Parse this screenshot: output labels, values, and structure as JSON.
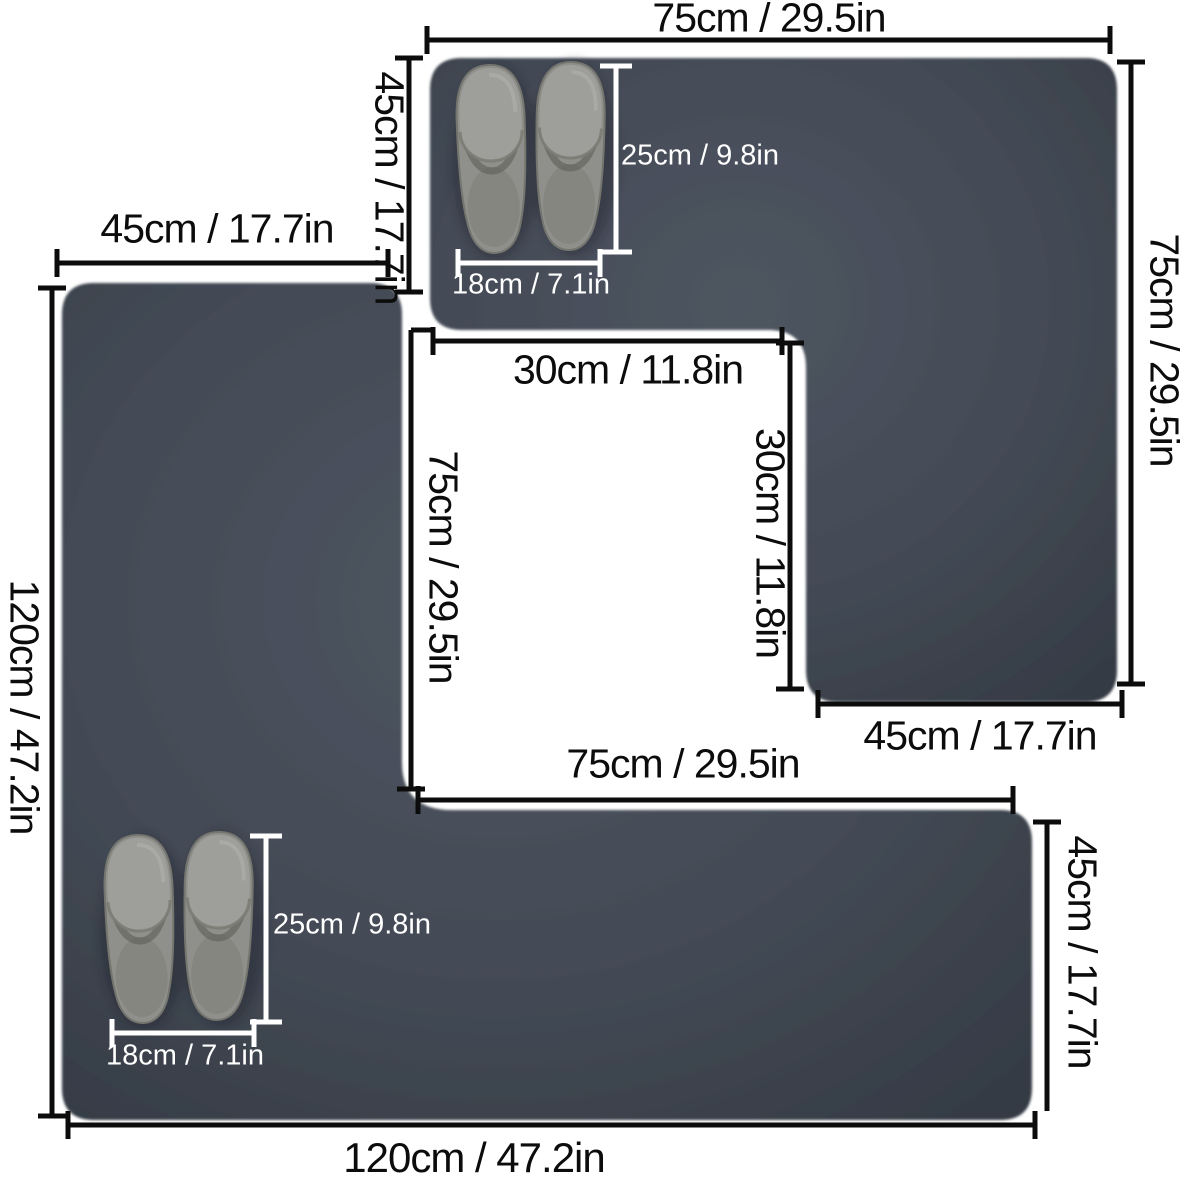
{
  "colors": {
    "background": "#ffffff",
    "mat": "#434a55",
    "mat_edge": "#343a44",
    "dimension_line": "#0c0c0c",
    "slipper_dimension_line": "#ffffff",
    "slipper": "#9a9a97"
  },
  "top_mat": {
    "top_width": "75cm / 29.5in",
    "left_height": "45cm / 17.7in",
    "right_height": "75cm / 29.5in",
    "notch_width": "30cm / 11.8in",
    "notch_height": "30cm / 11.8in",
    "foot_width": "45cm / 17.7in",
    "slipper_length": "25cm / 9.8in",
    "slipper_width": "18cm / 7.1in"
  },
  "bottom_mat": {
    "top_width": "45cm / 17.7in",
    "left_height": "120cm / 47.2in",
    "notch_height": "75cm / 29.5in",
    "arm_width": "75cm / 29.5in",
    "right_height": "45cm / 17.7in",
    "bottom_width": "120cm / 47.2in",
    "slipper_length": "25cm / 9.8in",
    "slipper_width": "18cm / 7.1in"
  }
}
